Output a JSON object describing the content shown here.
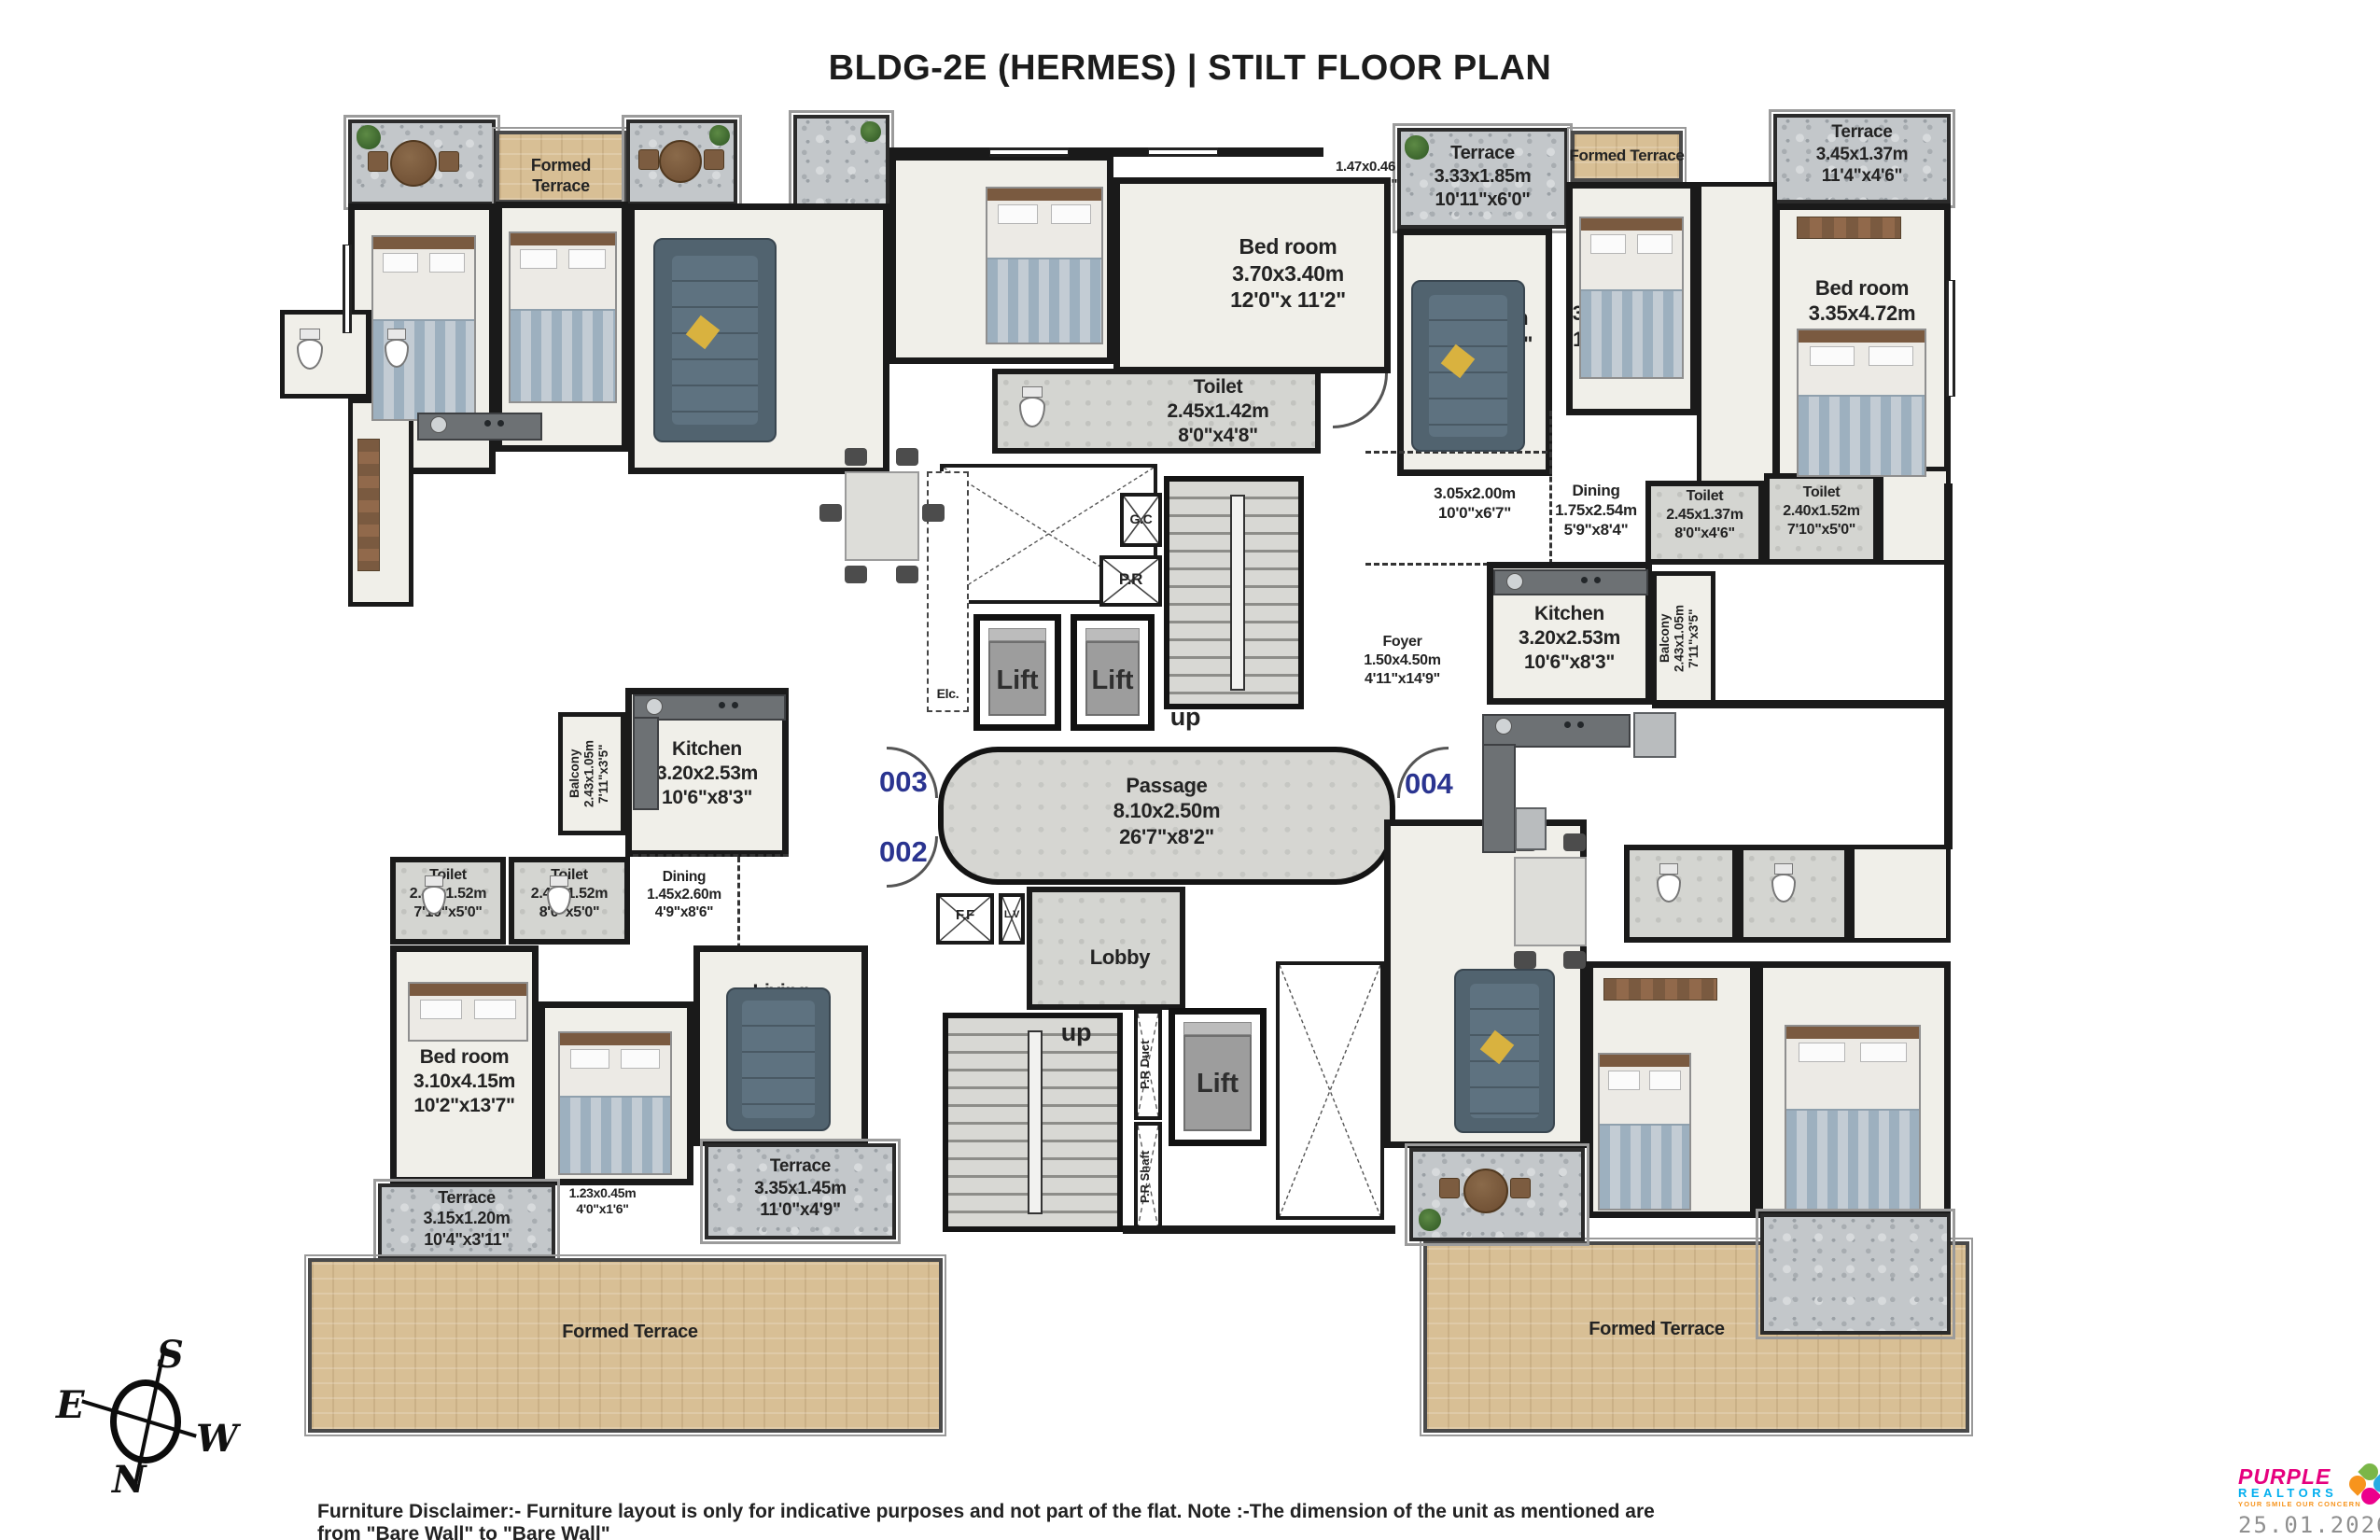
{
  "title": "BLDG-2E (HERMES) | STILT FLOOR PLAN",
  "units": {
    "u001": "001",
    "u002": "002",
    "u003": "003",
    "u004": "004"
  },
  "core": {
    "passage": {
      "name": "Passage",
      "m": "8.10x2.50m",
      "ft": "26'7\"x8'2\""
    },
    "foyer": {
      "name": "Foyer",
      "m": "1.50x4.50m",
      "ft": "4'11\"x14'9\""
    },
    "open305": {
      "m": "3.05x2.00m",
      "ft": "10'0\"x6'7\""
    },
    "lobby": "Lobby",
    "lift": "Lift",
    "up": "up",
    "elc": "Elc.",
    "gc": "G.C",
    "pr": "P.R",
    "ff": "F.F",
    "lv": "L.V",
    "prduct": "P.R Duct",
    "prshaft": "P.R Shaft"
  },
  "rooms": {
    "ft_tl": {
      "label": "Formed Terrace"
    },
    "ft_tr": {
      "label": "Formed Terrace"
    },
    "ft_bl": {
      "label": "Formed Terrace"
    },
    "ft_br": {
      "label": "Formed Terrace"
    },
    "terr_c": {
      "name": "Terrace",
      "m": "3.33x1.85m",
      "ft": "10'11\"x6'0\""
    },
    "terr_tr": {
      "name": "Terrace",
      "m": "3.45x1.37m",
      "ft": "11'4\"x4'6\""
    },
    "terr315": {
      "name": "Terrace",
      "m": "3.15x1.20m",
      "ft": "10'4\"x3'11\""
    },
    "terr335": {
      "name": "Terrace",
      "m": "3.35x1.45m",
      "ft": "11'0\"x4'9\""
    },
    "win_tl": {
      "m": "1.47x0.46",
      "ft": "4'10\"x1'6\""
    },
    "win_tr": {
      "m": "1.27x0.45",
      "ft": "4'2\"x1'6\""
    },
    "win_bl": {
      "m": "1.23x0.45m",
      "ft": "4'0\"x1'6\""
    },
    "bed370": {
      "name": "Bed room",
      "m": "3.70x3.40m",
      "ft": "12'0\"x 11'2\""
    },
    "living333": {
      "name": "Living",
      "m": "3.33x3.86m",
      "ft": "10'11\"x19'3\""
    },
    "bed305": {
      "name": "Bed room",
      "m": "3.05x3.65m",
      "ft": "10'0\"x12'0\""
    },
    "bed335": {
      "name": "Bed room",
      "m": "3.35x4.72m",
      "ft": "11'0\"x15'6\""
    },
    "toilet245142": {
      "name": "Toilet",
      "m": "2.45x1.42m",
      "ft": "8'0\"x4'8\""
    },
    "dining175": {
      "name": "Dining",
      "m": "1.75x2.54m",
      "ft": "5'9\"x8'4\""
    },
    "toilet245137": {
      "name": "Toilet",
      "m": "2.45x1.37m",
      "ft": "8'0\"x4'6\""
    },
    "toilet240152r": {
      "name": "Toilet",
      "m": "2.40x1.52m",
      "ft": "7'10\"x5'0\""
    },
    "kitchenR": {
      "name": "Kitchen",
      "m": "3.20x2.53m",
      "ft": "10'6\"x8'3\""
    },
    "balconyR": {
      "name": "Balcony",
      "m": "2.43x1.05m",
      "ft": "7'11\"x3'5\""
    },
    "kitchenL": {
      "name": "Kitchen",
      "m": "3.20x2.53m",
      "ft": "10'6\"x8'3\""
    },
    "balconyL": {
      "name": "Balcony",
      "m": "2.43x1.05m",
      "ft": "7'11\"x3'5\""
    },
    "toilet240152l": {
      "name": "Toilet",
      "m": "2.40x1.52m",
      "ft": "7'10\"x5'0\""
    },
    "toilet245152l": {
      "name": "Toilet",
      "m": "2.45x1.52m",
      "ft": "8'0\"x5'0\""
    },
    "dining145": {
      "name": "Dining",
      "m": "1.45x2.60m",
      "ft": "4'9\"x8'6\""
    },
    "living335": {
      "name": "Living",
      "m": "3.35x4.95m",
      "ft": "11'0\"x16'3\""
    },
    "bed310": {
      "name": "Bed room",
      "m": "3.10x4.15m",
      "ft": "10'2\"x13'7\""
    },
    "bed300": {
      "name": "Bed room",
      "m": "3.00x3.35m",
      "ft": "9'10\"x11'0\""
    }
  },
  "compass": {
    "n": "N",
    "s": "S",
    "e": "E",
    "w": "W"
  },
  "footer": {
    "disclaimer": "Furniture Disclaimer:- Furniture layout is only for indicative purposes and not part of the flat. Note :-The dimension of the unit as mentioned are from \"Bare Wall\" to \"Bare Wall\"",
    "date": "25.01.2026"
  },
  "logo": {
    "name1": "PURPLE",
    "name2": "REALTORS",
    "tagline": "YOUR SMILE OUR CONCERN"
  },
  "colors": {
    "unit_number": "#2a3490",
    "wall": "#1a1a1a",
    "stone": "#c3c7ca",
    "tan": "#d8bf95",
    "floor": "#f0efe9"
  }
}
